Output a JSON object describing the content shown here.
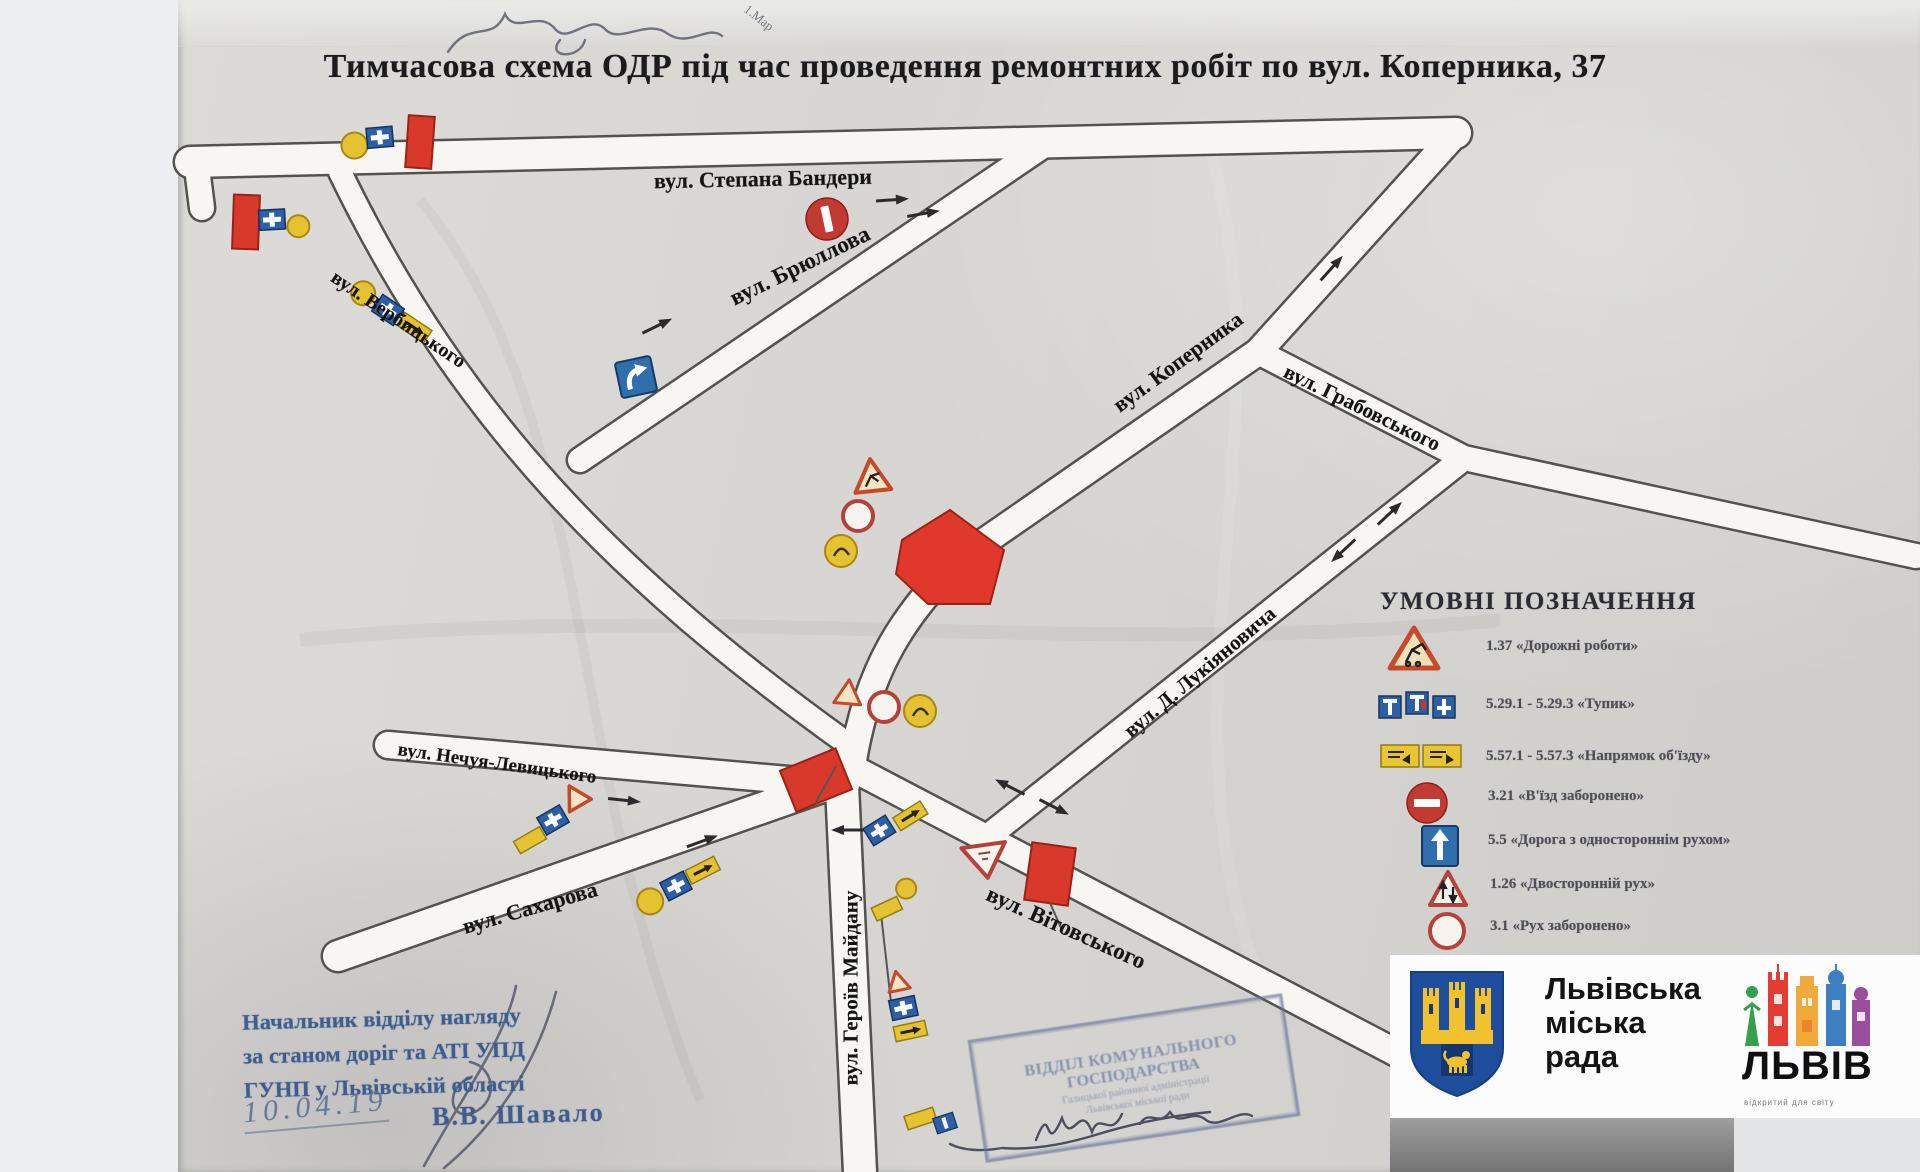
{
  "title": "Тимчасова схема ОДР під час проведення ремонтних робіт по вул. Коперника, 37",
  "handwriting": {
    "top_note": "1.Мар"
  },
  "map": {
    "streets": [
      {
        "name": "вул. Степана Бандери"
      },
      {
        "name": "вул. Брюллова"
      },
      {
        "name": "вул. Вербицького"
      },
      {
        "name": "вул. Коперника"
      },
      {
        "name": "вул. Грабовського"
      },
      {
        "name": "вул. Д. Лукіяновича"
      },
      {
        "name": "вул. Нечуя-Левицького"
      },
      {
        "name": "вул. Сахарова"
      },
      {
        "name": "вул. Вітовського"
      },
      {
        "name": "вул. Героїв Майдану"
      }
    ]
  },
  "legend": {
    "title": "УМОВНІ ПОЗНАЧЕННЯ",
    "items": [
      {
        "code": "1.37",
        "label": "«Дорожні роботи»",
        "icon": "road-works-sign"
      },
      {
        "code": "5.29.1 - 5.29.3",
        "label": "«Тупик»",
        "icon": "dead-end-signs"
      },
      {
        "code": "5.57.1 - 5.57.3",
        "label": "«Напрямок об'їзду»",
        "icon": "detour-direction-signs"
      },
      {
        "code": "3.21",
        "label": "«В'їзд заборонено»",
        "icon": "no-entry-sign"
      },
      {
        "code": "5.5",
        "label": "«Дорога з одностороннім рухом»",
        "icon": "one-way-road-sign"
      },
      {
        "code": "1.26",
        "label": "«Двосторонній рух»",
        "icon": "two-way-traffic-sign"
      },
      {
        "code": "3.1",
        "label": "«Рух заборонено»",
        "icon": "no-movement-sign"
      }
    ]
  },
  "approval": {
    "line1": "Начальник відділу нагляду",
    "line2": "за станом доріг та АТІ УПД",
    "line3": "ГУНП у Львівській області",
    "date": "10.04.19",
    "signed_by": "В.В. Шавало"
  },
  "stamp": {
    "line1": "ВІДДІЛ КОМУНАЛЬНОГО",
    "line2": "ГОСПОДАРСТВА",
    "line3": "Галицької районної адміністрації",
    "line4": "Львівської міської ради"
  },
  "footer_logos": {
    "council": {
      "line1": "Львівська",
      "line2": "міська",
      "line3": "рада"
    },
    "brand": {
      "wordmark": "ЛЬВІВ",
      "tagline": "відкритий для світу"
    }
  },
  "colors": {
    "accent_red": "#d8392b",
    "sign_blue": "#2d5ea6",
    "sign_yellow": "#e8c531",
    "stamp_blue": "#3d5c8f",
    "shield_blue": "#1e4e9c",
    "shield_yellow": "#f2c22e"
  }
}
